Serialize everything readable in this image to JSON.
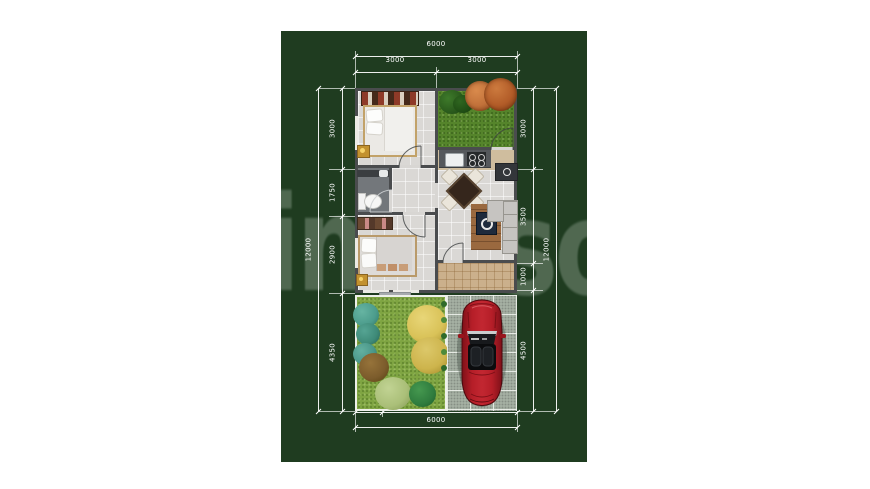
{
  "scene": {
    "description": "Top-view house floor plan photo on a dark green background",
    "watermark": {
      "left": "im",
      "right": "so"
    },
    "objects": [
      "double-bed",
      "wardrobe",
      "nightstand",
      "toilet",
      "bathroom-vanity",
      "single-bed",
      "dresser",
      "dining-table-with-4-chairs",
      "kitchen-counter",
      "sink",
      "stove",
      "tv-cabinet",
      "coffee-table",
      "sofa",
      "courtyard-trees",
      "garden-shrubs",
      "red-sports-car",
      "paved-carport",
      "entry-porch"
    ]
  },
  "dimensions": {
    "top": {
      "total": "6000",
      "segments": [
        "3000",
        "3000"
      ]
    },
    "left": {
      "total": "12000",
      "segments": [
        "3000",
        "1750",
        "2900",
        "4350"
      ]
    },
    "right": {
      "total": "12000",
      "segments": [
        "3000",
        "3500",
        "1000",
        "4500"
      ]
    },
    "bottom": {
      "total": "6000",
      "segments": [
        "1000",
        "5000"
      ]
    }
  },
  "colors": {
    "page_background": "#ffffff",
    "photo_background": "#1f3c20",
    "dimension_lines": "#ffffff",
    "walls": "#4a4c4e",
    "garden_grass": "#7fa542",
    "courtyard_grass": "#55842b",
    "carport_paving": "#a4afa2",
    "porch_tile": "#cbb08c",
    "car_body": "#b51e28"
  }
}
